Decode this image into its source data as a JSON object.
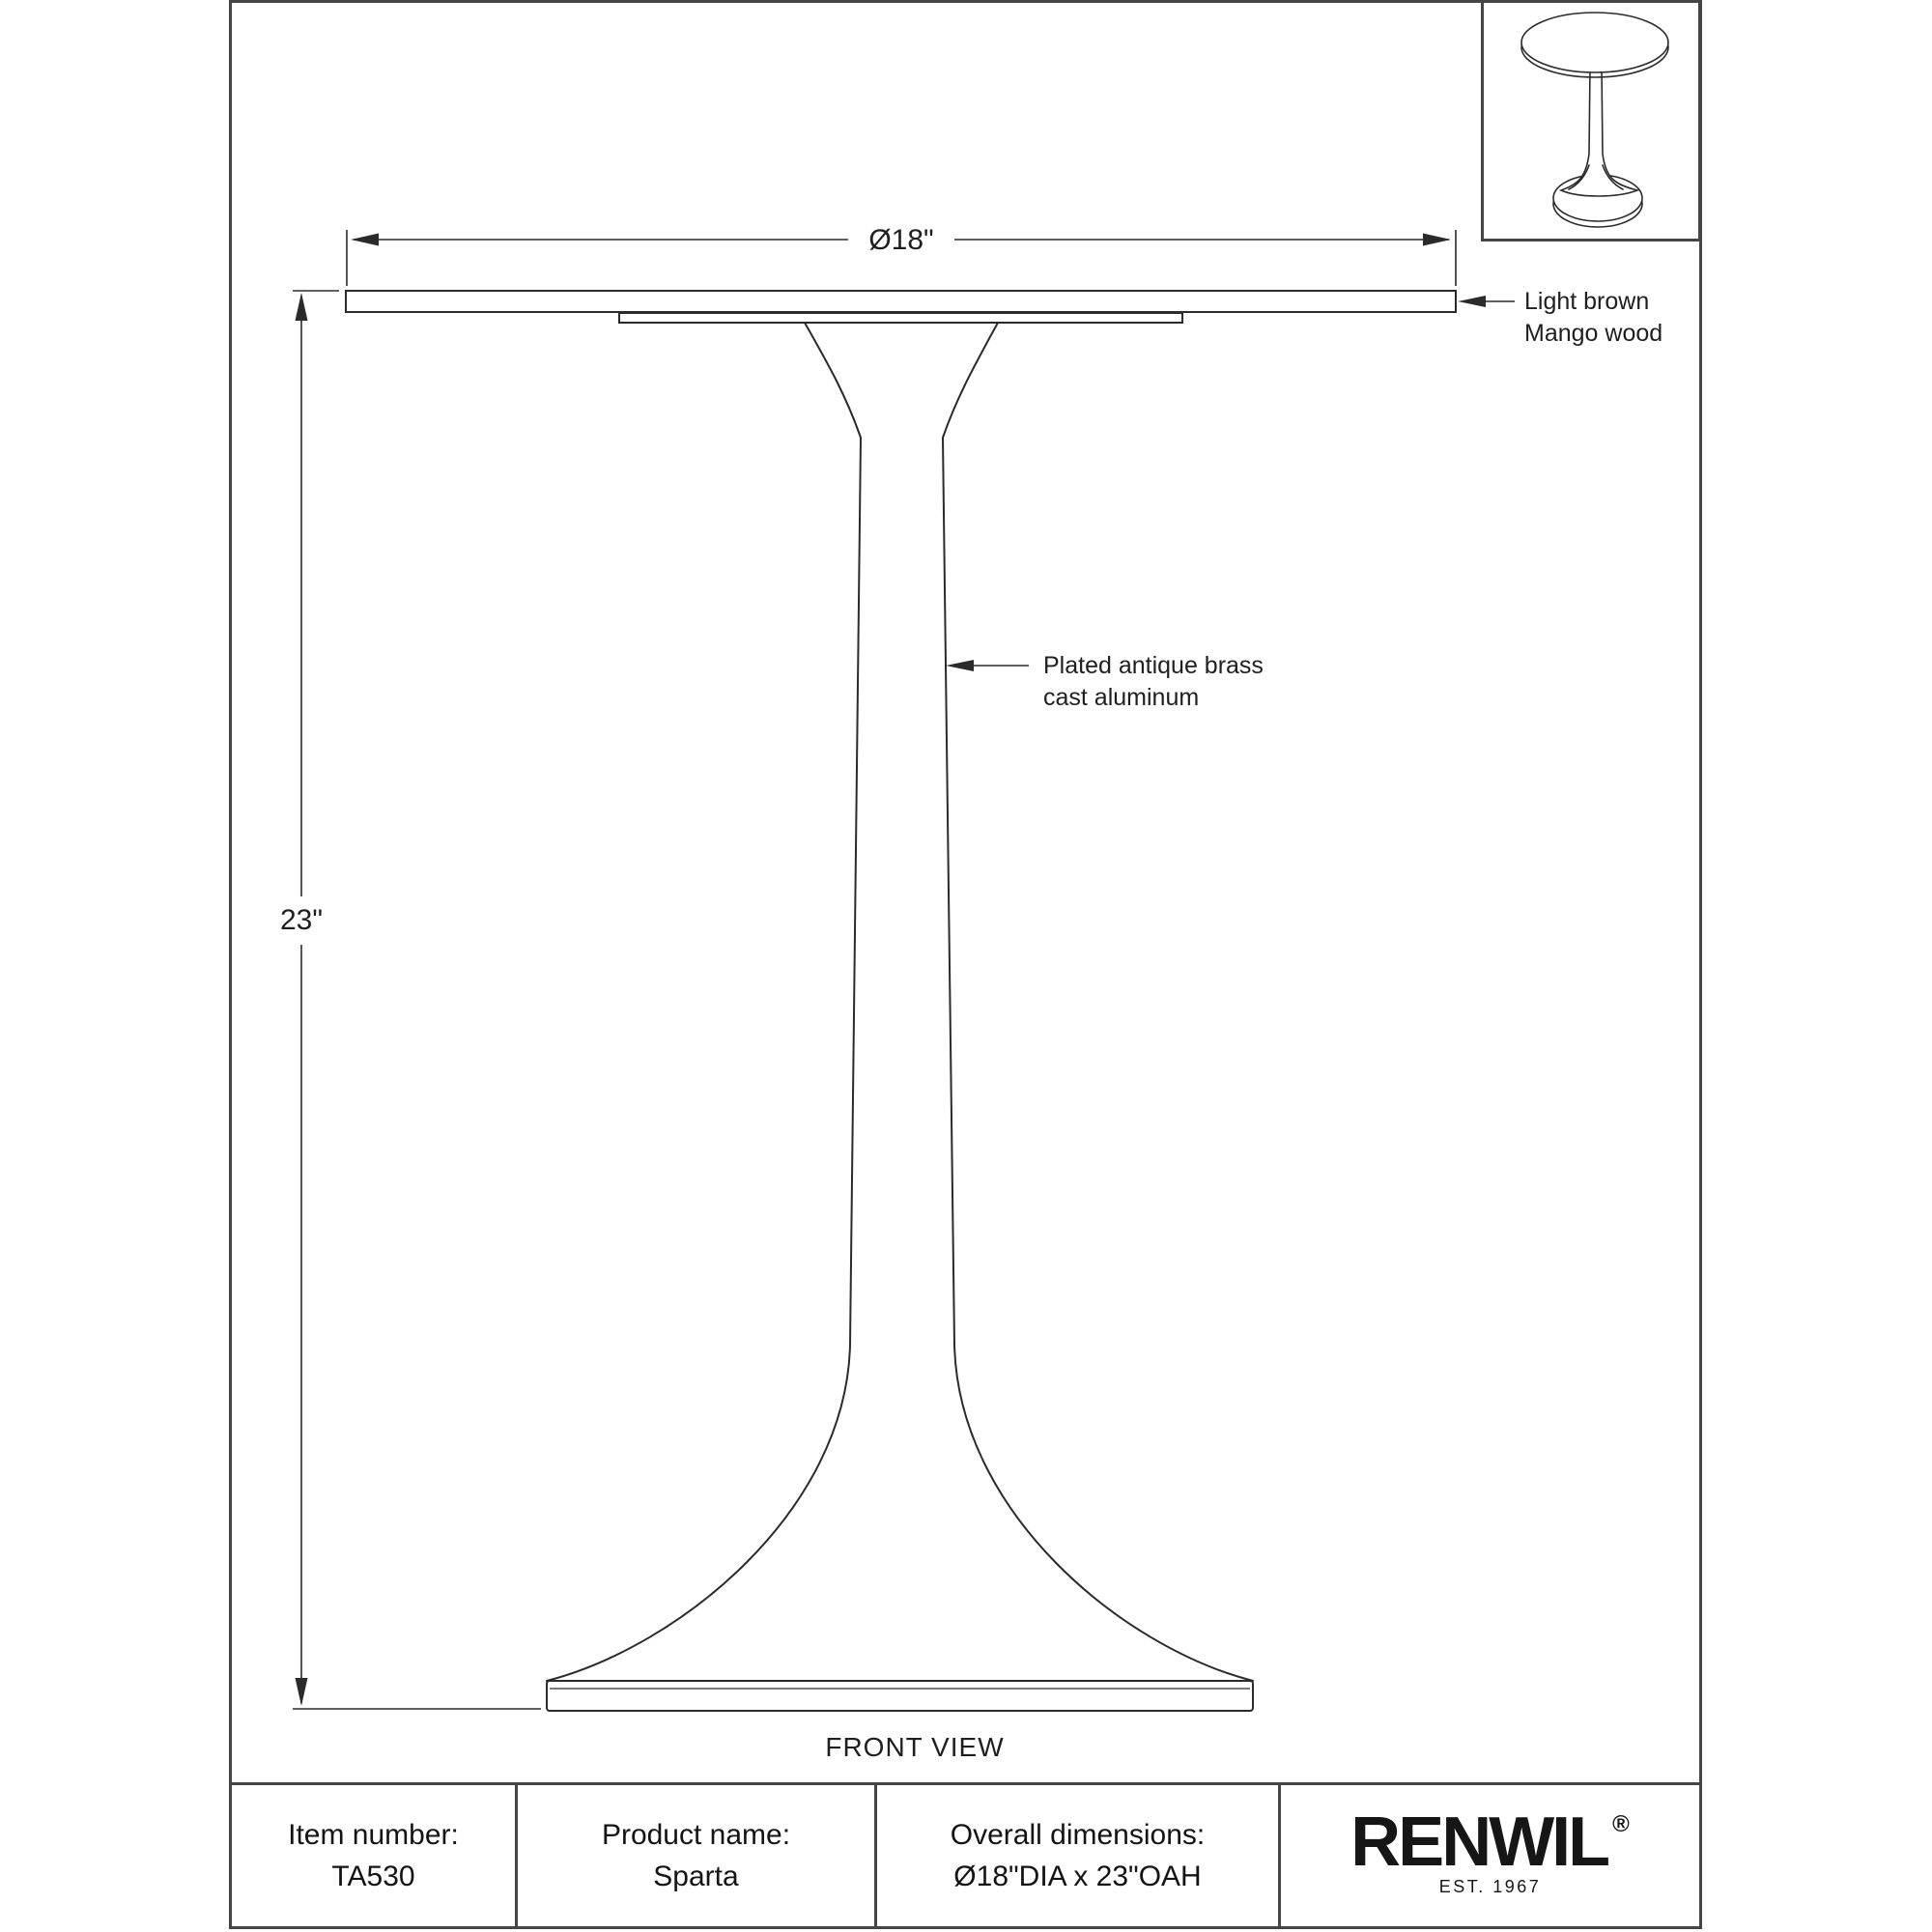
{
  "drawing": {
    "view_label": "FRONT VIEW",
    "dimensions": {
      "diameter": "Ø18\"",
      "height": "23\""
    },
    "annotations": {
      "top_material": {
        "line1": "Light brown",
        "line2": "Mango wood"
      },
      "pedestal_material": {
        "line1": "Plated antique brass",
        "line2": "cast aluminum"
      }
    }
  },
  "info_table": {
    "item": {
      "label": "Item number:",
      "value": "TA530"
    },
    "product": {
      "label": "Product name:",
      "value": "Sparta"
    },
    "overall": {
      "label": "Overall dimensions:",
      "value": "Ø18\"DIA x 23\"OAH"
    },
    "brand": {
      "name": "RENWIL",
      "registered": "®",
      "established": "EST. 1967"
    }
  },
  "colors": {
    "line": "#2b2b2b",
    "frame": "#454545",
    "text": "#1a1a1a"
  }
}
